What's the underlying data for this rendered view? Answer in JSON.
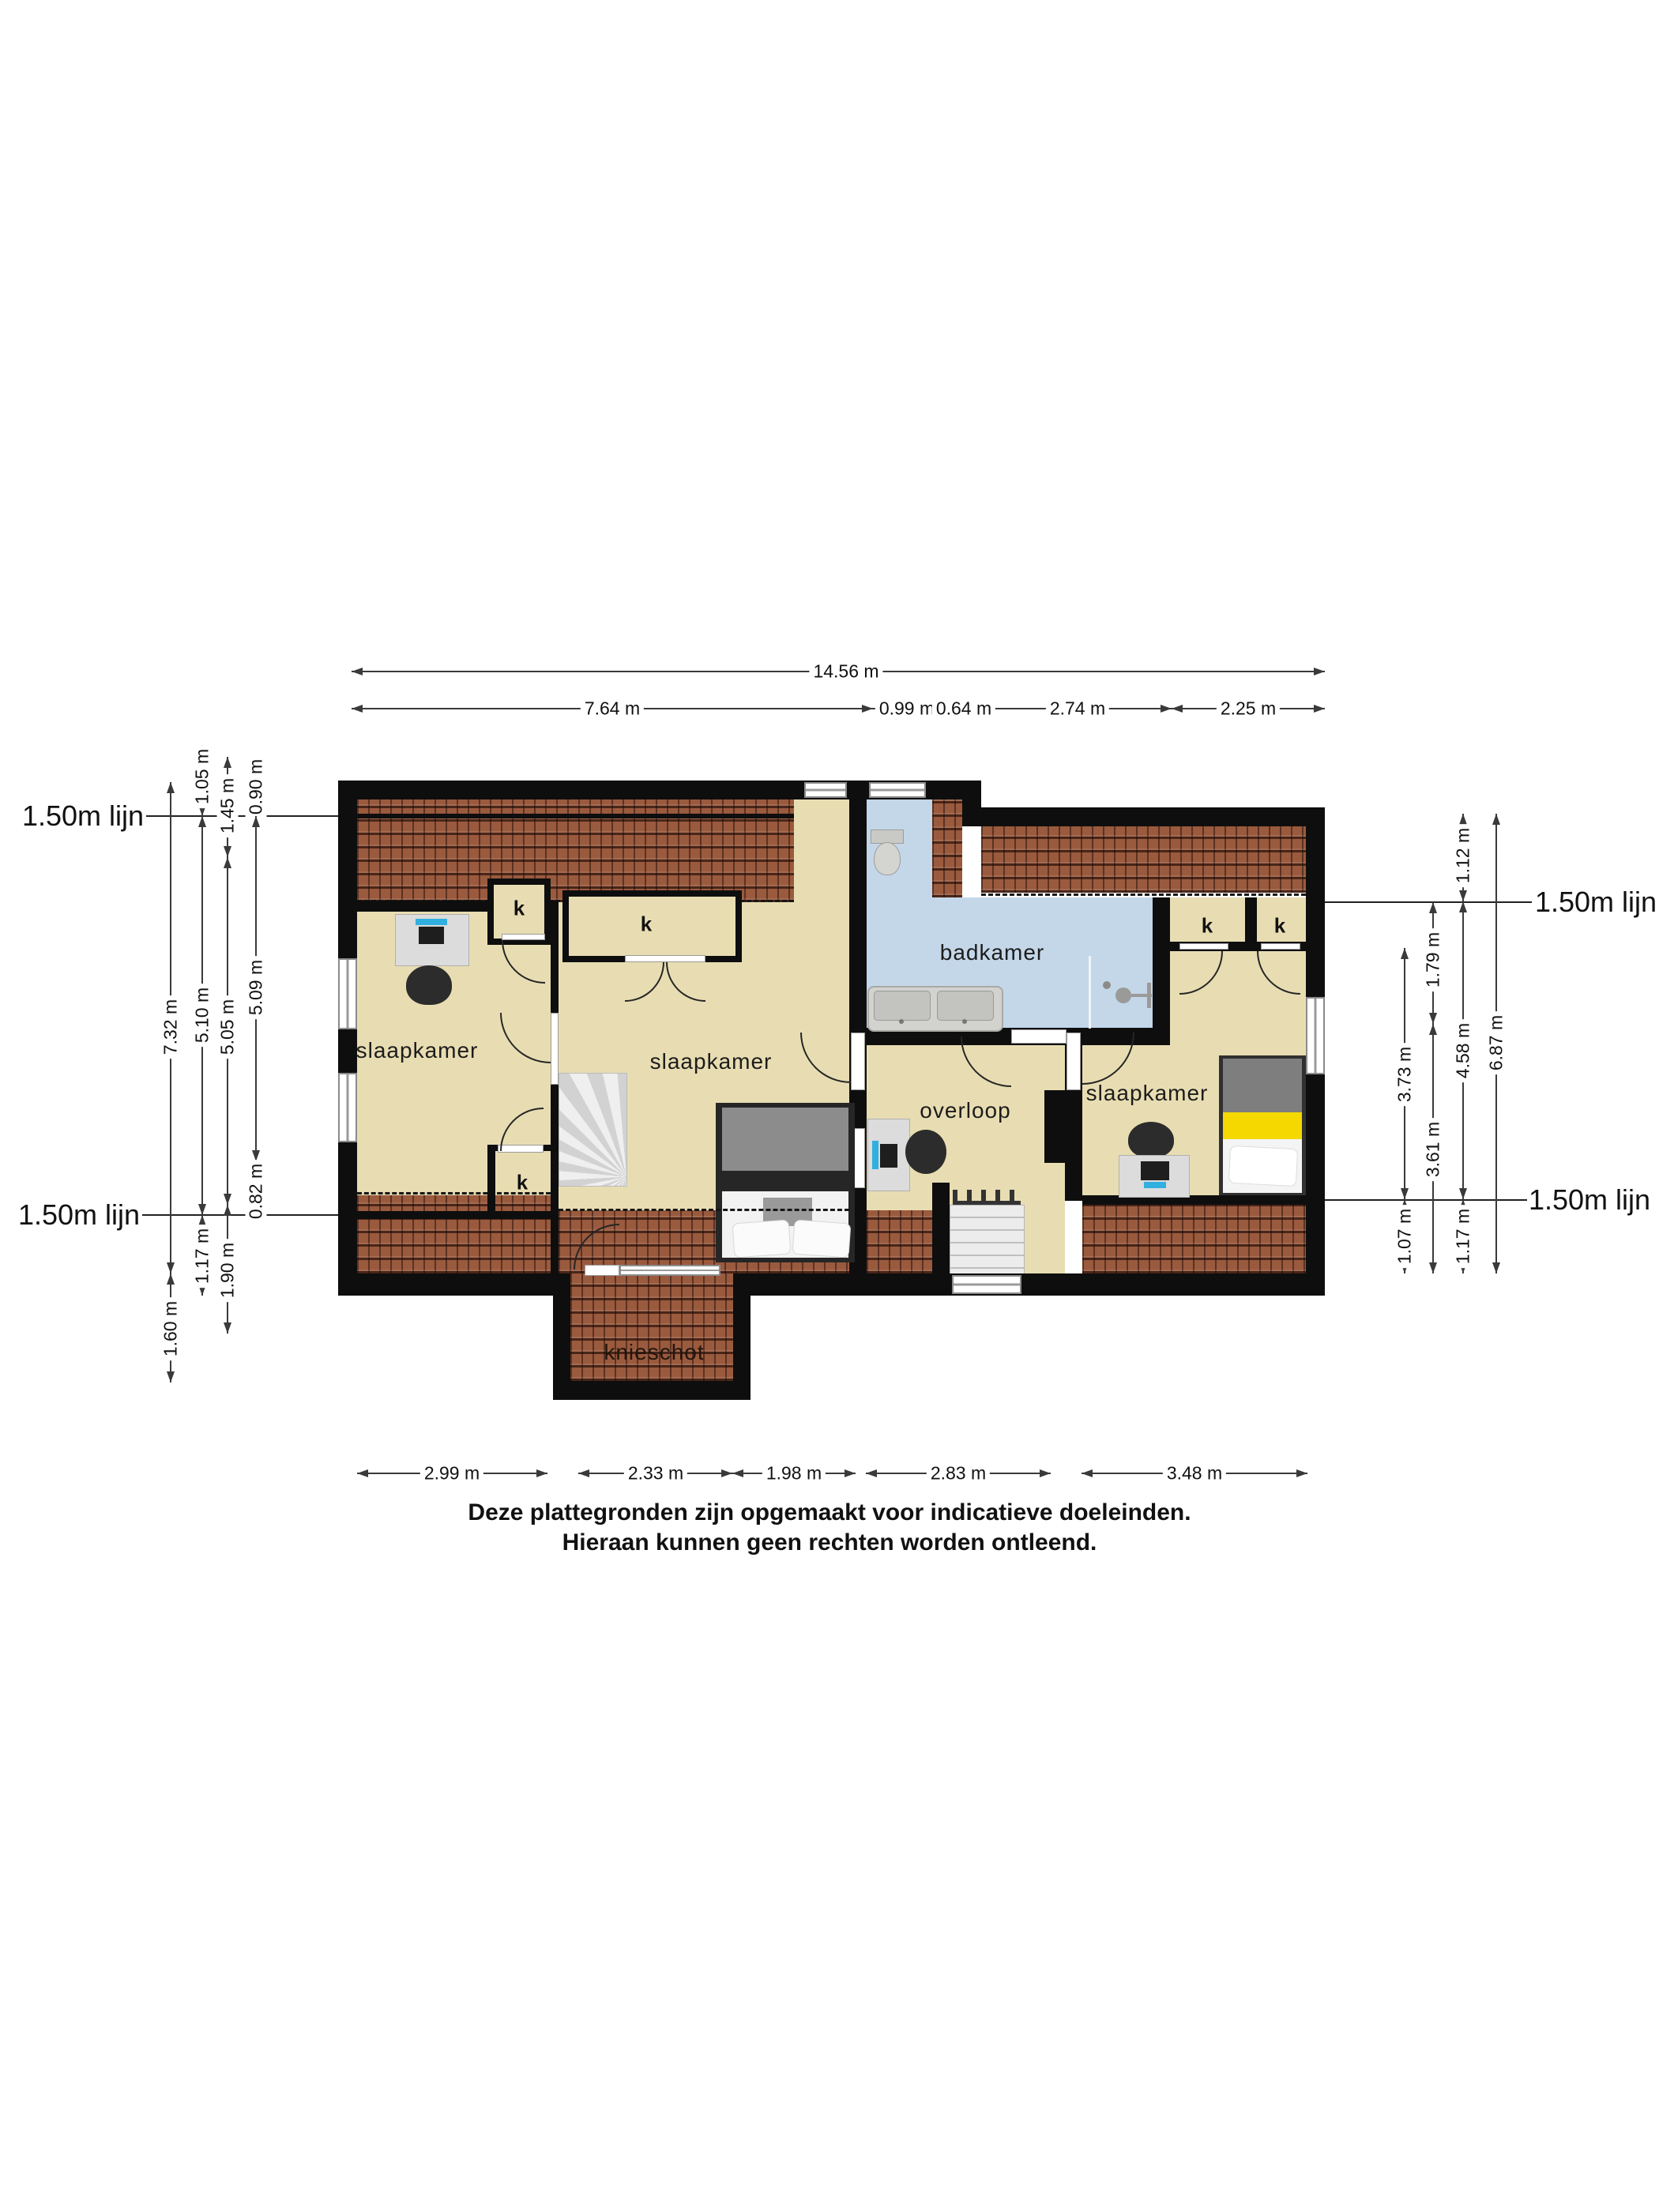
{
  "floorplan": {
    "rooms": {
      "bedroom": "slaapkamer",
      "bathroom": "badkamer",
      "landing": "overloop",
      "knee_wall": "knieschot",
      "closet": "k"
    },
    "ref_line_label": "1.50m lijn",
    "dims": {
      "top_total": "14.56 m",
      "top": [
        "7.64 m",
        "0.99 m",
        "0.64 m",
        "2.74 m",
        "2.25 m"
      ],
      "left_col1": [
        "7.32 m",
        "1.60 m"
      ],
      "left_col2": [
        "1.05 m",
        "5.10 m",
        "1.17 m"
      ],
      "left_col3": [
        "1.45 m",
        "5.05 m",
        "1.90 m"
      ],
      "left_col4": [
        "0.90 m",
        "5.09 m",
        "0.82 m"
      ],
      "right_col1": [
        "3.73 m",
        "1.07 m"
      ],
      "right_col2": [
        "1.79 m",
        "3.61 m"
      ],
      "right_col3": [
        "1.12 m",
        "4.58 m",
        "1.17 m"
      ],
      "right_col4": [
        "6.87 m"
      ],
      "bottom": [
        "2.99 m",
        "2.33 m",
        "1.98 m",
        "2.83 m",
        "3.48 m"
      ]
    },
    "disclaimer": [
      "Deze plattegronden zijn opgemaakt voor indicatieve doeleinden.",
      "Hieraan kunnen geen rechten worden ontleend."
    ],
    "colors": {
      "wall": "#0e0e0e",
      "floor": "#e8ddb2",
      "bathroom_floor": "#c4d7e9",
      "roof_tiles": "#9a5a3e",
      "bed_accent": "#f4d800",
      "monitor_accent": "#31b0e0"
    }
  }
}
